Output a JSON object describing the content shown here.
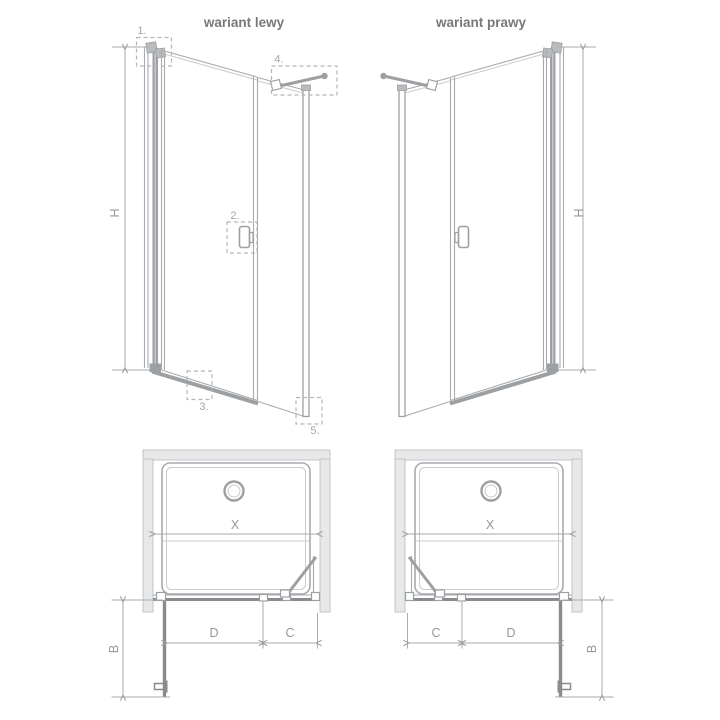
{
  "titles": {
    "left": "wariant lewy",
    "right": "wariant prawy"
  },
  "dimension_labels": {
    "height": "H",
    "opening_width": "X",
    "door_width": "D",
    "fixed_panel_width": "C",
    "door_projection": "B"
  },
  "callout_labels": {
    "wall_profile": "1.",
    "handle": "2.",
    "threshold": "3.",
    "support_bar": "4.",
    "bottom_corner": "5."
  },
  "colors": {
    "line": "#a8aaad",
    "lineLight": "#c9cbcd",
    "profile": "#9da0a3",
    "dark": "#898b8e",
    "wallFill": "#e7e8e9",
    "wallStroke": "#c3c5c7",
    "dash": "#b4b6b8",
    "text": "#77787b",
    "dimText": "#96989b",
    "numText": "#a4a6a9",
    "bg": "#ffffff"
  }
}
